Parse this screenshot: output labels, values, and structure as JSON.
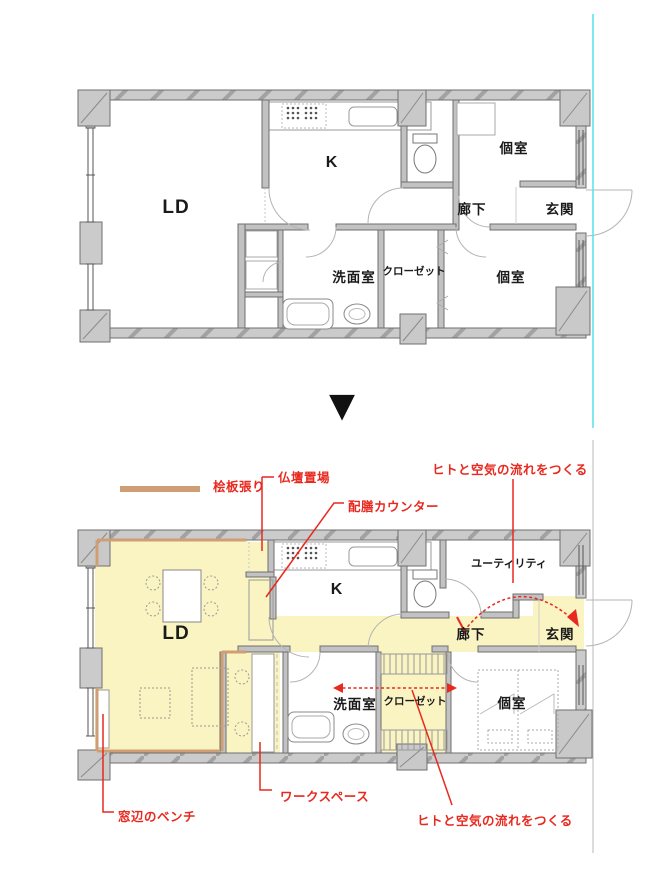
{
  "colors": {
    "wall_fill": "#cbcbcb",
    "wall_stroke": "#6f6f6f",
    "room_highlight": "#faf4c2",
    "hinoki_tan": "#cf9e74",
    "annotation_red": "#e8291f",
    "guide_cyan": "#57e2ea",
    "line_gray": "#9a9a9a",
    "label_black": "#1a1a1a"
  },
  "transition": {
    "symbol": "▼"
  },
  "legend": {
    "label": "桧板張り"
  },
  "plan_before": {
    "rooms": {
      "ld": "LD",
      "kitchen": "K",
      "bedroom_top": "個室",
      "corridor": "廊下",
      "entrance": "玄関",
      "washroom": "洗面室",
      "closet": "クローゼット",
      "bedroom_bottom": "個室"
    }
  },
  "plan_after": {
    "rooms": {
      "ld": "LD",
      "kitchen": "K",
      "utility": "ユーティリティ",
      "corridor": "廊下",
      "entrance": "玄関",
      "washroom": "洗面室",
      "closet": "クローゼット",
      "bedroom": "個室"
    },
    "annotations": {
      "altar": "仏壇置場",
      "serving_counter": "配膳カウンター",
      "flow_top": "ヒトと空気の流れをつくる",
      "flow_bottom": "ヒトと空気の流れをつくる",
      "window_bench": "窓辺のベンチ",
      "workspace": "ワークスペース"
    }
  }
}
